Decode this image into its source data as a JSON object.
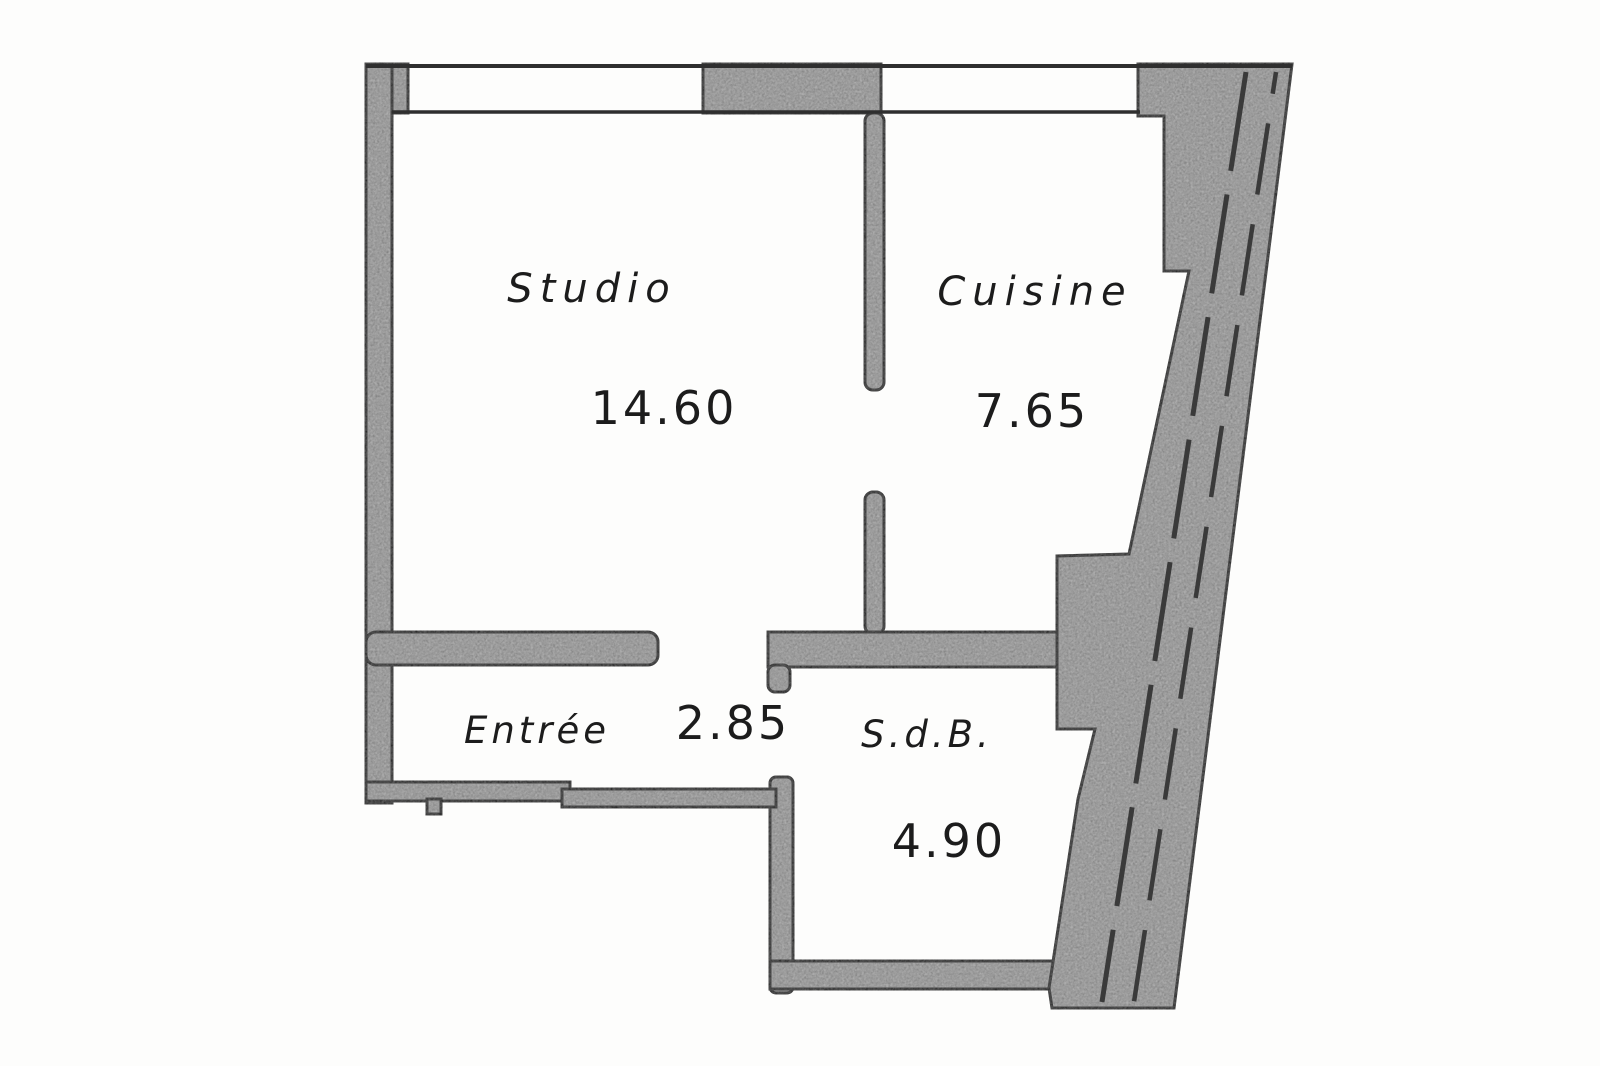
{
  "palette": {
    "background": "#fdfdfc",
    "wall_fill": "#adadad",
    "line": "#2f2f2f",
    "dash_line": "#3a3a3a",
    "text": "#1c1c1c"
  },
  "rooms": [
    {
      "name": "Studio",
      "area": "14.60"
    },
    {
      "name": "Cuisine",
      "area": "7.65"
    },
    {
      "name": "Entrée",
      "area": "2.85"
    },
    {
      "name": "S.d.B.",
      "area": "4.90"
    }
  ]
}
